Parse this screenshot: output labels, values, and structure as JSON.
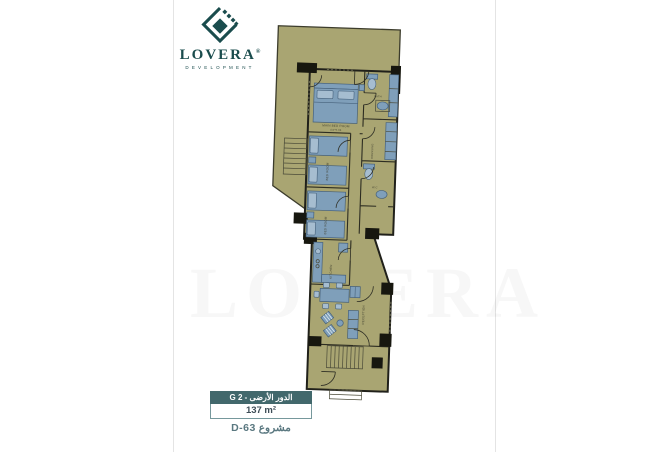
{
  "page": {
    "watermark": "LOVERA"
  },
  "logo": {
    "name": "LOVERA",
    "registered": "®",
    "tagline": "DEVELOPMENT"
  },
  "colors": {
    "brand_teal": "#1a4c4d",
    "floor_olive": "#a9a572",
    "furniture_blue": "#7f9fba",
    "wall_dark": "#2c2c21",
    "footer_header_bg": "#42686c"
  },
  "plan": {
    "labels": {
      "main_bedroom": "MAIN BED ROOM",
      "main_bedroom_dims": "4.0*5.05",
      "bedroom_2": "BED ROOM",
      "bedroom_3": "BED ROOM",
      "kitchen": "KITCHEN",
      "reception": "RECEPTION",
      "dressing": "DRESSING",
      "bath": "BATH",
      "wc": "W.C"
    }
  },
  "footer": {
    "floor_label": "الدور الأرضى - G 2",
    "area": "137 m²",
    "project": "مشروع D-63"
  }
}
